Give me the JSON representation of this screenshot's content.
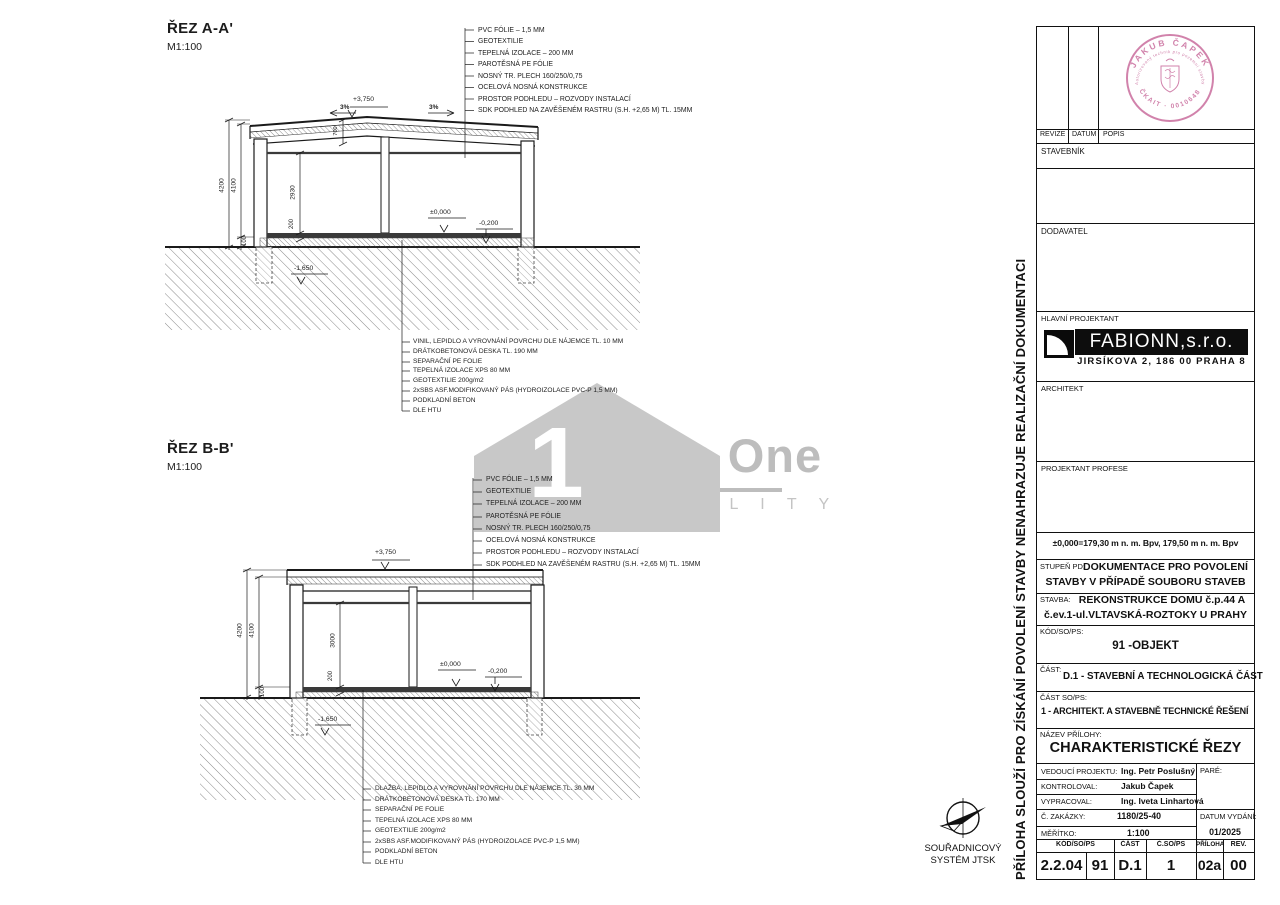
{
  "sections": [
    {
      "title": "ŘEZ A-A'",
      "scale": "M1:100",
      "roof_callouts": [
        "PVC FÓLIE – 1,5 MM",
        "GEOTEXTILIE",
        "TEPELNÁ IZOLACE – 200 MM",
        "PAROTĚSNÁ PE FÓLIE",
        "NOSNÝ TR. PLECH 160/250/0,75",
        "OCELOVÁ NOSNÁ KONSTRUKCE",
        "PROSTOR PODHLEDU – ROZVODY INSTALACÍ",
        "SDK PODHLED NA ZAVĚŠENÉM RASTRU (S.H. +2,65 M) TL. 15MM"
      ],
      "floor_callouts": [
        "VINIL, LEPIDLO A VYROVNÁNÍ POVRCHU DLE NÁJEMCE TL. 10 MM",
        "DRÁTKOBETONOVÁ DESKA TL. 190 MM",
        "SEPARAČNÍ PE FOLIE",
        "TEPELNÁ IZOLACE XPS 80 MM",
        "GEOTEXTILIE 200g/m2",
        "2xSBS ASF.MODIFIKOVANÝ PÁS (HYDROIZOLACE PVC-P 1,5 MM)",
        "PODKLADNÍ BETON",
        "DLE HTU"
      ],
      "dims": {
        "height_total": "4200",
        "height_inner": "4100",
        "plinth": "100",
        "room": "2930",
        "floor": "200",
        "roof_build": "700",
        "top_level": "+3,750",
        "slope_left": "3%",
        "slope_right": "3%",
        "lvl_zero": "±0,000",
        "lvl_floor": "-0,200",
        "lvl_found": "-1,650"
      }
    },
    {
      "title": "ŘEZ B-B'",
      "scale": "M1:100",
      "roof_callouts": [
        "PVC FÓLIE – 1,5 MM",
        "GEOTEXTILIE",
        "TEPELNÁ IZOLACE – 200 MM",
        "PAROTĚSNÁ PE FÓLIE",
        "NOSNÝ TR. PLECH 160/250/0,75",
        "OCELOVÁ NOSNÁ KONSTRUKCE",
        "PROSTOR PODHLEDU – ROZVODY INSTALACÍ",
        "SDK PODHLED NA ZAVĚŠENÉM RASTRU (S.H. +2,65 M) TL. 15MM"
      ],
      "floor_callouts": [
        "DLAŽBA, LEPIDLO A VYROVNÁNÍ POVRCHU DLE NÁJEMCE TL. 30 MM",
        "DRÁTKOBETONOVÁ DESKA TL. 170 MM",
        "SEPARAČNÍ PE FOLIE",
        "TEPELNÁ IZOLACE XPS 80 MM",
        "GEOTEXTILIE 200g/m2",
        "2xSBS ASF.MODIFIKOVANÝ PÁS (HYDROIZOLACE PVC-P 1,5 MM)",
        "PODKLADNÍ BETON",
        "DLE HTU"
      ],
      "dims": {
        "height_total": "4200",
        "height_inner": "4100",
        "plinth": "100",
        "room": "3000",
        "floor": "200",
        "top_level": "+3,750",
        "lvl_zero": "±0,000",
        "lvl_floor": "-0,200",
        "lvl_found": "-1,650"
      }
    }
  ],
  "watermark": {
    "house_number": "1",
    "brand_line1": "Top One",
    "brand_line2": "R E A L I T Y",
    "gray": "#c8c8c8"
  },
  "north": {
    "line1": "SOUŘADNICOVÝ",
    "line2": "SYSTÉM JTSK"
  },
  "side_note": "PŘÍLOHA SLOUŽÍ PRO ZÍSKÁNÍ POVOLENÍ  STAVBY NENAHRAZUJE REALIZAČNÍ DOKUMENTACI",
  "stamp": {
    "arc_top": "JAKUB ČAPEK",
    "arc_inner": "Autorizovaný technik pro pozemní stavby",
    "arc_bottom": "ČKAIT · 0010648",
    "color": "#c96d9d"
  },
  "titleblock": {
    "rev_headers": {
      "c1": "REVIZE",
      "c2": "DATUM",
      "c3": "POPIS"
    },
    "stavebnik": "STAVEBNÍK",
    "dodavatel": "DODAVATEL",
    "hlavni_projektant": "HLAVNÍ PROJEKTANT",
    "logo": {
      "name": "FABIONN,s.r.o.",
      "address": "JIRSÍKOVA 2, 186 00 PRAHA 8"
    },
    "architekt": "ARCHITEKT",
    "projektant_profese": "PROJEKTANT  PROFESE",
    "elevation_note": "±0,000=179,30 m n. m. Bpv, 179,50 m n. m. Bpv",
    "stupen_label": "STUPEŇ  PD:",
    "stupen_value1": "DOKUMENTACE PRO POVOLENÍ",
    "stupen_value2": "STAVBY V PŘÍPADĚ SOUBORU STAVEB",
    "stavba_label": "STAVBA:",
    "stavba_value1": "REKONSTRUKCE DOMU č.p.44 A",
    "stavba_value2": "č.ev.1-ul.VLTAVSKÁ-ROZTOKY U PRAHY",
    "kod_label": "KÓD/SO/PS:",
    "kod_value": "91 -OBJEKT",
    "cast_label": "ČÁST:",
    "cast_value": "D.1 - STAVEBNÍ A TECHNOLOGICKÁ ČÁST",
    "cast_sops_label": "ČÁST  SO/PS:",
    "cast_sops_value": "1 - ARCHITEKT. A STAVEBNĚ TECHNICKÉ ŘEŠENÍ",
    "nazev_label": "NÁZEV  PŘÍLOHY:",
    "nazev_value": "CHARAKTERISTICKÉ ŘEZY",
    "people": [
      {
        "label": "VEDOUCÍ  PROJEKTU:",
        "value": "Ing. Petr  Poslušný"
      },
      {
        "label": "KONTROLOVAL:",
        "value": "Jakub  Čapek"
      },
      {
        "label": "VYPRACOVAL:",
        "value": "Ing. Iveta  Linhartová"
      }
    ],
    "pare_label": "PARÉ:",
    "zakazka_label": "Č.  ZAKÁZKY:",
    "zakazka_value": "1180/25-40",
    "meritko_label": "MĚŘÍTKO:",
    "meritko_value": "1:100",
    "datum_label": "DATUM  VYDÁNÍ:",
    "datum_value": "01/2025",
    "bottom_headers": {
      "h1": "KÓD/SO/PS",
      "h2": "ČÁST",
      "h3": "Č.SO/PS",
      "h4": "PŘÍLOHA",
      "h5": "REV."
    },
    "bottom_values": {
      "v1": "2.2.04",
      "v2": "91",
      "v3": "D.1",
      "v4": "1",
      "v5": "02a",
      "v6": "00"
    }
  }
}
